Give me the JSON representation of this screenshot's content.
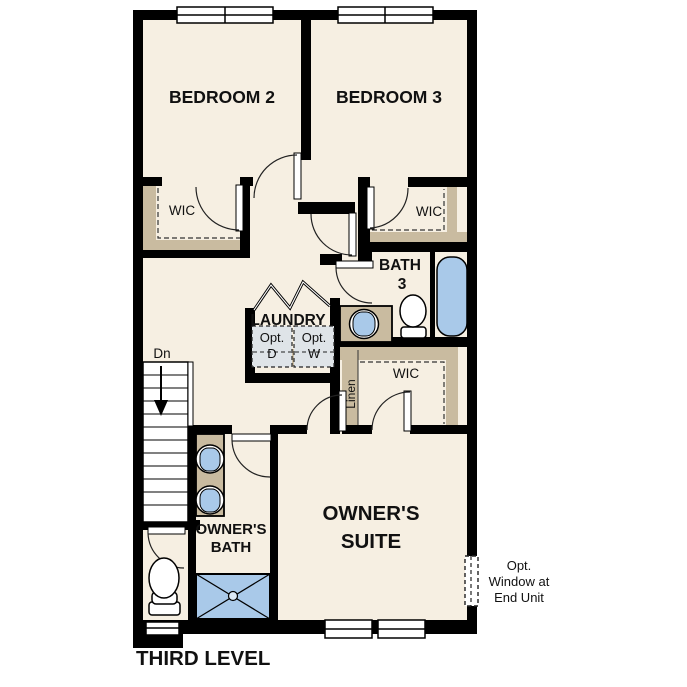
{
  "title": "THIRD LEVEL",
  "colors": {
    "wall": "#000000",
    "floor": "#f6efe2",
    "shelf_tan": "#c9bba0",
    "fixture_blue": "#a9c9e9",
    "appliance_box": "#dfe4e8",
    "background": "#ffffff"
  },
  "rooms": {
    "bedroom2": "BEDROOM 2",
    "bedroom3": "BEDROOM 3",
    "wic_bedroom2": "WIC",
    "wic_bedroom3": "WIC",
    "bath3_line1": "BATH",
    "bath3_line2": "3",
    "laundry": "LAUNDRY",
    "owners_wic": "WIC",
    "linen": "Linen",
    "owners_bath_line1": "OWNER'S",
    "owners_bath_line2": "BATH",
    "owners_suite_line1": "OWNER'S",
    "owners_suite_line2": "SUITE"
  },
  "annotations": {
    "stairs_down": "Dn",
    "opt_dryer_line1": "Opt.",
    "opt_dryer_line2": "D",
    "opt_washer_line1": "Opt.",
    "opt_washer_line2": "W",
    "opt_window_line1": "Opt.",
    "opt_window_line2": "Window at",
    "opt_window_line3": "End Unit",
    "level_title": "THIRD LEVEL"
  }
}
